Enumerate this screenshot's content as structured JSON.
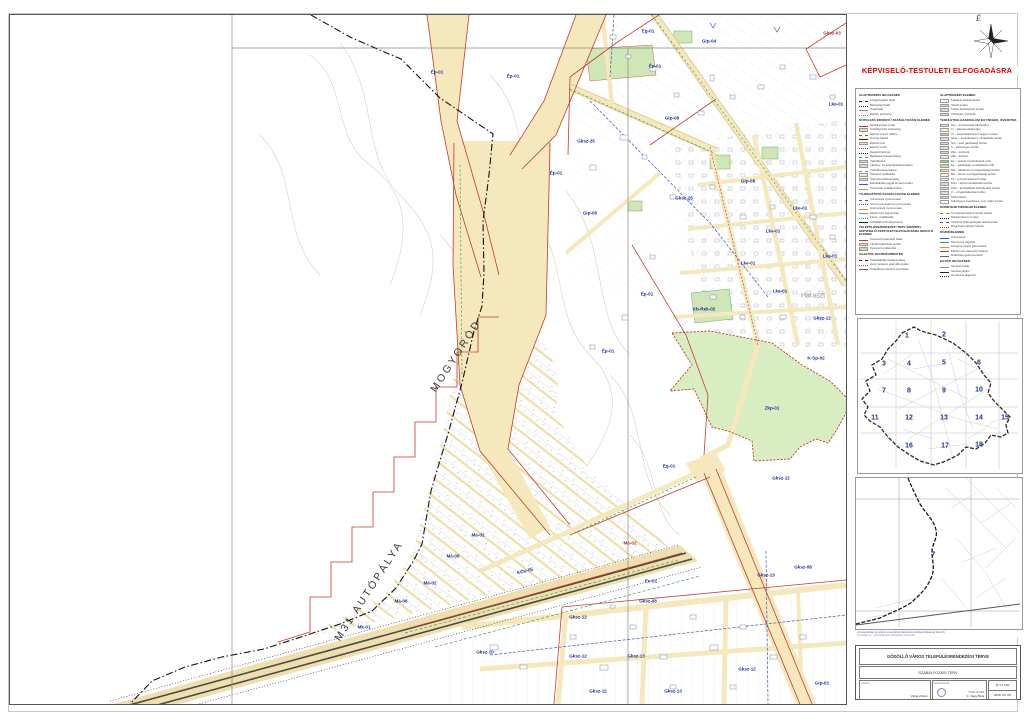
{
  "page": {
    "approval": "KÉPVISELŐ-TESTÜLETI ELFOGADÁSRA",
    "north_label": "É"
  },
  "map": {
    "labels": [
      {
        "t": "Ép-01",
        "x": 427,
        "y": 57
      },
      {
        "t": "Ép-01",
        "x": 503,
        "y": 61
      },
      {
        "t": "Eg-01",
        "x": 638,
        "y": 16
      },
      {
        "t": "Gksz-03",
        "x": 822,
        "y": 18,
        "c": "red"
      },
      {
        "t": "Gip-04",
        "x": 699,
        "y": 26
      },
      {
        "t": "Ép-01",
        "x": 645,
        "y": 51
      },
      {
        "t": "Gksz-25",
        "x": 576,
        "y": 126
      },
      {
        "t": "Gip-08",
        "x": 662,
        "y": 103
      },
      {
        "t": "Ép-01",
        "x": 546,
        "y": 158
      },
      {
        "t": "Gip-05",
        "x": 580,
        "y": 198
      },
      {
        "t": "Gip-08",
        "x": 738,
        "y": 166
      },
      {
        "t": "Gksz-25",
        "x": 674,
        "y": 183
      },
      {
        "t": "Lke-01",
        "x": 790,
        "y": 193
      },
      {
        "t": "Lke-01",
        "x": 763,
        "y": 216
      },
      {
        "t": "Lke-01",
        "x": 820,
        "y": 241
      },
      {
        "t": "Lke-01",
        "x": 738,
        "y": 248
      },
      {
        "t": "Lke-01",
        "x": 770,
        "y": 276
      },
      {
        "t": "Lke-01",
        "x": 826,
        "y": 89
      },
      {
        "t": "Ép-01",
        "x": 637,
        "y": 279
      },
      {
        "t": "Kb-Rek-02",
        "x": 694,
        "y": 294
      },
      {
        "t": "Haraszt",
        "x": 803,
        "y": 281,
        "c": "gray"
      },
      {
        "t": "Gksz-12",
        "x": 812,
        "y": 303
      },
      {
        "t": "K-Sp-02",
        "x": 806,
        "y": 343
      },
      {
        "t": "Zkp-01",
        "x": 762,
        "y": 393
      },
      {
        "t": "Ép-01",
        "x": 598,
        "y": 336
      },
      {
        "t": "Eg-01",
        "x": 659,
        "y": 451
      },
      {
        "t": "Gksz-12",
        "x": 771,
        "y": 463
      },
      {
        "t": "Má-02",
        "x": 468,
        "y": 520
      },
      {
        "t": "Má-06",
        "x": 443,
        "y": 541
      },
      {
        "t": "Má-02",
        "x": 420,
        "y": 568
      },
      {
        "t": "Má-06",
        "x": 391,
        "y": 586
      },
      {
        "t": "Mk-01",
        "x": 354,
        "y": 612
      },
      {
        "t": "Má-02",
        "x": 620,
        "y": 528,
        "c": "red"
      },
      {
        "t": "Ev-01",
        "x": 641,
        "y": 566
      },
      {
        "t": "KÖu-05",
        "x": 515,
        "y": 556,
        "r": -14
      },
      {
        "t": "Gksz-10",
        "x": 475,
        "y": 637
      },
      {
        "t": "Gksz-12",
        "x": 568,
        "y": 602
      },
      {
        "t": "Gksz-12",
        "x": 568,
        "y": 641
      },
      {
        "t": "Gksz-13",
        "x": 626,
        "y": 641
      },
      {
        "t": "Gksz-12",
        "x": 588,
        "y": 676
      },
      {
        "t": "Gksz-13",
        "x": 663,
        "y": 676
      },
      {
        "t": "Gksz-08",
        "x": 638,
        "y": 586
      },
      {
        "t": "Gksz-13",
        "x": 756,
        "y": 560
      },
      {
        "t": "Gksz-08",
        "x": 793,
        "y": 552
      },
      {
        "t": "Gksz-12",
        "x": 737,
        "y": 654
      },
      {
        "t": "Gip-01",
        "x": 812,
        "y": 668
      },
      {
        "t": "MOGYORÓD",
        "x": 446,
        "y": 341,
        "r": -57,
        "s": "huge"
      },
      {
        "t": "M31 AUTÓPÁLYA",
        "x": 359,
        "y": 576,
        "r": -57,
        "s": "huge"
      }
    ]
  },
  "legend": {
    "columns": [
      [
        {
          "header": "ALAPTÉRKÉPI JELÖLÉSEK",
          "items": [
            {
              "sw": "swl c-blk dash",
              "label": "Közigazgatási határ"
            },
            {
              "sw": "swl c-blk dot",
              "label": "Belterületi határ"
            },
            {
              "sw": "swl c-gry",
              "label": "Telekhatár"
            },
            {
              "sw": "swl c-gry dot",
              "label": "Épület, építmény"
            }
          ]
        },
        {
          "header": "KÖTELEZŐ ÉRVÉNYŰ SZABÁLYOZÁSI ELEMEK",
          "items": [
            {
              "sw": "swl c-red",
              "label": "Szabályozási vonal"
            },
            {
              "sw": "f f-tan",
              "label": "Szabályozási szélesség"
            },
            {
              "sw": "swl c-red dash",
              "label": "Építési övezet határa"
            },
            {
              "sw": "swl c-blk",
              "label": "Övezet határa"
            },
            {
              "sw": "f f-tan2",
              "label": "Építési hely"
            },
            {
              "sw": "swl c-red dot",
              "label": "Építési vonal"
            },
            {
              "sw": "swl c-blk dot",
              "label": "Megszüntető jel"
            },
            {
              "sw": "swl c-grn dash",
              "label": "Beültetési kötelezettség"
            },
            {
              "sw": "f f-green",
              "label": "Védőfásítás"
            },
            {
              "sw": "f f-pink",
              "label": "Látvány- és településképvédelem"
            },
            {
              "sw": "swl c-gry dash",
              "label": "Védőtávolság határa"
            },
            {
              "sw": "f f-lgreen",
              "label": "Kötelező zöldfelület"
            },
            {
              "sw": "f f-yellow",
              "label": "Útépítési kötelezettség"
            },
            {
              "sw": "swl c-blu",
              "label": "Elővásárlási joggal érintett terület"
            },
            {
              "sw": "swl c-org",
              "label": "Közterület szabályozása"
            }
          ]
        },
        {
          "header": "TÁJÉKOZTATÓ SZABÁLYOZÁSI ELEMEK",
          "items": [
            {
              "sw": "swl c-blu dash",
              "label": "Vízvezeték nyomvonala"
            },
            {
              "sw": "swl c-blu dot",
              "label": "Szennyvízcsatorna nyomvonala"
            },
            {
              "sw": "swl c-org",
              "label": "Gázvezeték nyomvonala"
            },
            {
              "sw": "swl c-gry",
              "label": "Elektromos légvezeték"
            },
            {
              "sw": "swl c-grn dot",
              "label": "Fasor, védőfásítás"
            },
            {
              "sw": "swl c-blk",
              "label": "Földalatti közműépítmény"
            }
          ]
        },
        {
          "header": "TELEPÜLÉSSZERKEZETI TERV SZERINTI, KÉPVISELŐ-TESTÜLETI ELFOGADÁSRA KERÜLŐ ELEMEK",
          "items": [
            {
              "sw": "swl c-red",
              "label": "Tervezett belterületi határ"
            },
            {
              "sw": "f f-tan",
              "label": "Távlati fejlesztési terület"
            },
            {
              "sw": "f f-mgreen",
              "label": "Tervezett erdőterület"
            }
          ]
        },
        {
          "header": "SAJÁTOS JOGINTÉZMÉNYEK",
          "items": [
            {
              "sw": "swl c-blk dash",
              "label": "Telekalakítási kötelezettség"
            },
            {
              "sw": "swl c-red dot",
              "label": "Helyi védelem alatt álló épület"
            },
            {
              "sw": "swl c-pur",
              "label": "Településrendezési szerződés"
            }
          ]
        }
      ],
      [
        {
          "header": "ALAPTÉRKÉPI ELEMEK",
          "items": [
            {
              "sw": "f f-white",
              "label": "Kialakult telekstruktúra"
            },
            {
              "sw": "f f-gray",
              "label": "Vasúti terület"
            },
            {
              "sw": "f f-tan",
              "label": "Közúti közlekedési terület"
            },
            {
              "sw": "f f-lblue",
              "label": "Vízfelület, vízfolyás"
            }
          ]
        },
        {
          "header": "TERÜLETFELHASZNÁLÁSI EGYSÉGEK, ÖVEZETEK",
          "items": [
            {
              "sw": "f f-yellow",
              "label": "Lke – kertvárosias lakóterület"
            },
            {
              "sw": "f f-lyellow",
              "label": "Lf – falusias lakóterület"
            },
            {
              "sw": "f f-orange",
              "label": "Vt – településközpont vegyes terület"
            },
            {
              "sw": "f f-lilac",
              "label": "Gksz – kereskedelmi, szolgáltató terület"
            },
            {
              "sw": "f f-gray",
              "label": "Gip – ipari gazdasági terület"
            },
            {
              "sw": "f f-pink",
              "label": "K – különleges terület"
            },
            {
              "sw": "f f-green",
              "label": "Zkp – közpark"
            },
            {
              "sw": "f f-lgreen",
              "label": "Zkk – közkert"
            },
            {
              "sw": "f f-dgreen",
              "label": "Ev – védelmi rendeltetésű erdő"
            },
            {
              "sw": "f f-mgreen",
              "label": "Eg – gazdasági rendeltetésű erdő"
            },
            {
              "sw": "f f-tan2",
              "label": "Má – általános mezőgazdasági terület"
            },
            {
              "sw": "f f-lyellow",
              "label": "Mk – kertes mezőgazdasági terület"
            },
            {
              "sw": "f f-white",
              "label": "Tk – természetközeli terület"
            },
            {
              "sw": "f f-tan",
              "label": "KÖu – közúti közlekedési terület"
            },
            {
              "sw": "f f-gray",
              "label": "KÖk – kötöttpályás közlekedési terület"
            },
            {
              "sw": "f f-lblue",
              "label": "V – vízgazdálkodási terület"
            },
            {
              "sw": "f f-green",
              "label": "Véderdősáv"
            },
            {
              "sw": "f f-white",
              "label": "Különleges beépítésre nem szánt terület"
            }
          ]
        },
        {
          "header": "KÖRNYEZETVÉDELMI ELEMEK",
          "items": [
            {
              "sw": "swl c-grn dash",
              "label": "Természetvédelmi terület határa"
            },
            {
              "sw": "swl c-blk dot",
              "label": "Nitrátérzékeny terület"
            },
            {
              "sw": "swl c-blu dash",
              "label": "Vízbázis hidrogeológiai védőövezete"
            },
            {
              "sw": "swl c-red dot",
              "label": "Régészeti lelőhely határa"
            }
          ]
        },
        {
          "header": "KÖZMŰELEMEK",
          "items": [
            {
              "sw": "swl c-blu",
              "label": "Vízvezeték"
            },
            {
              "sw": "swl c-grn",
              "label": "Szennyvíz főgyűjtő"
            },
            {
              "sw": "swl c-org",
              "label": "Középnyomású gázvezeték"
            },
            {
              "sw": "swl c-red",
              "label": "Elektromos főelosztó hálózat"
            },
            {
              "sw": "swl c-pur",
              "label": "Hírközlési gerincvezeték"
            }
          ]
        },
        {
          "header": "EGYÉB JELÖLÉSEK",
          "items": [
            {
              "sw": "swl c-gry",
              "label": "Szelvényhatár"
            },
            {
              "sw": "swl c-blk",
              "label": "Szelvényszám"
            },
            {
              "sw": "swl c-blk dot",
              "label": "Geodéziai alappont"
            }
          ]
        }
      ]
    ]
  },
  "index_map": {
    "cells": [
      {
        "n": "1",
        "x": 49,
        "y": 17
      },
      {
        "n": "2",
        "x": 86,
        "y": 16
      },
      {
        "n": "3",
        "x": 26,
        "y": 45
      },
      {
        "n": "4",
        "x": 51,
        "y": 45
      },
      {
        "n": "5",
        "x": 86,
        "y": 44
      },
      {
        "n": "6",
        "x": 121,
        "y": 44
      },
      {
        "n": "7",
        "x": 26,
        "y": 72
      },
      {
        "n": "8",
        "x": 51,
        "y": 72
      },
      {
        "n": "9",
        "x": 86,
        "y": 72
      },
      {
        "n": "10",
        "x": 121,
        "y": 71
      },
      {
        "n": "11",
        "x": 17,
        "y": 99
      },
      {
        "n": "12",
        "x": 51,
        "y": 99
      },
      {
        "n": "13",
        "x": 86,
        "y": 99
      },
      {
        "n": "14",
        "x": 121,
        "y": 99
      },
      {
        "n": "15",
        "x": 147,
        "y": 99
      },
      {
        "n": "16",
        "x": 51,
        "y": 127
      },
      {
        "n": "17",
        "x": 87,
        "y": 127
      },
      {
        "n": "18",
        "x": 121,
        "y": 126
      }
    ]
  },
  "locator": {
    "sheet": "7",
    "cap1": "Az alaptérkép az állami topográfiai alaptérkép felhasználásával készült.",
    "cap2": "A tervlap a 7. jelű szelvény területére érvényes."
  },
  "titleblock": {
    "line1": "GÖDÖLLŐ VÁROS TELEPÜLÉSRENDEZÉSI TERVE",
    "line2": "SZABÁLYOZÁSI TERV",
    "designer_label": "tervező:",
    "designer": "Varga Zoltán",
    "lead_label": "vezető tervező:",
    "lead": "K. Nagy Béla",
    "lead_id": "TT/1É 13-1064",
    "scale": "M 1:4 000",
    "date": "2008. 05. 08."
  }
}
